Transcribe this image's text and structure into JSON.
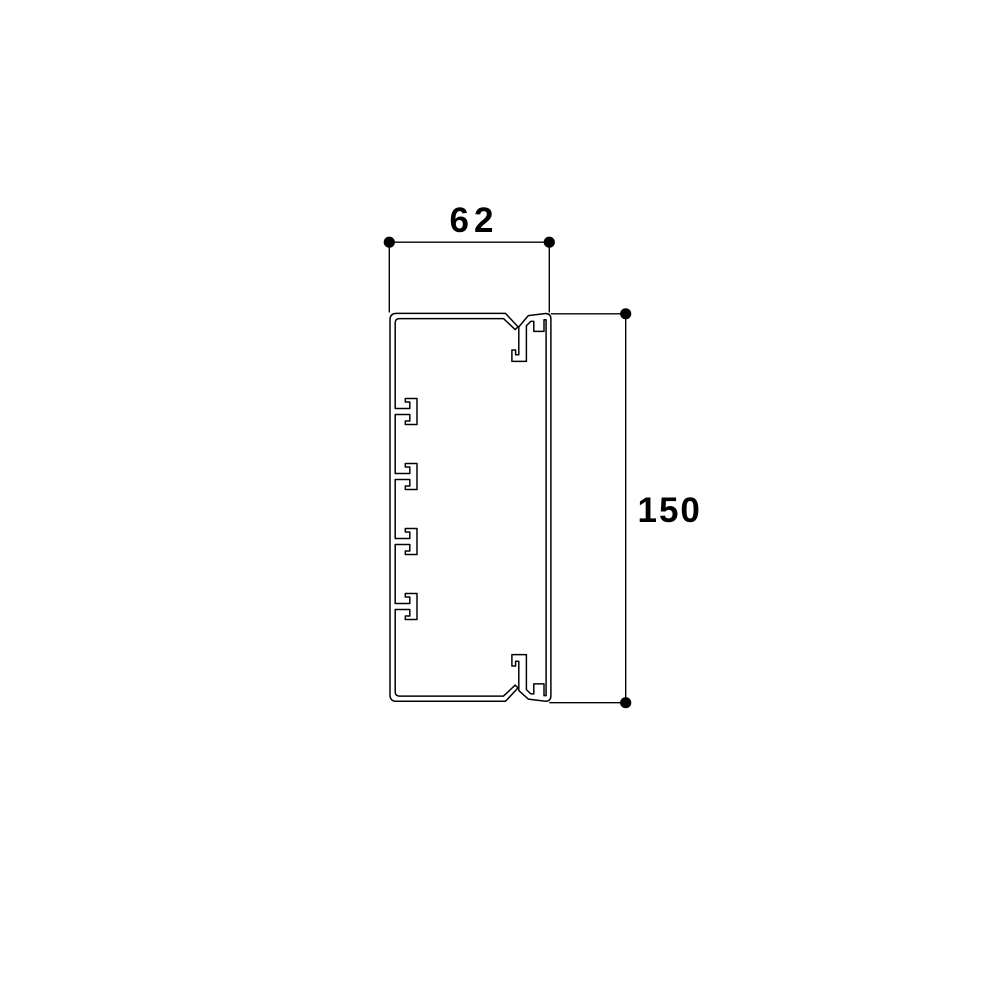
{
  "page": {
    "background_color": "#ffffff"
  },
  "drawing": {
    "type": "technical-cross-section-diagram",
    "line_color": "#000000",
    "material_fill_color": "#ffffff",
    "profile": {
      "description": "cable-trunking-cross-section-with-snap-on-cover",
      "partition_stud_count": 4,
      "cover_clip_count": 2
    },
    "dimensions": {
      "width": {
        "label": "62"
      },
      "height": {
        "label": "150"
      }
    }
  }
}
